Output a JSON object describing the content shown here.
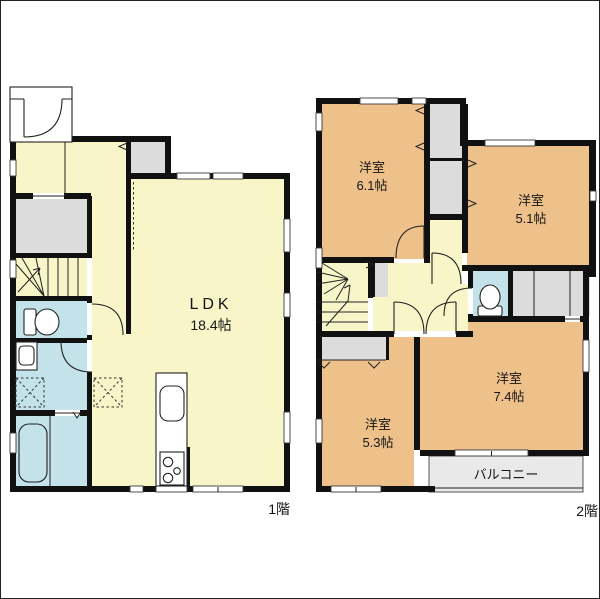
{
  "floors": [
    {
      "label": "1階",
      "rooms": [
        {
          "name": "LDK",
          "size": "18.4帖"
        }
      ]
    },
    {
      "label": "2階",
      "rooms": [
        {
          "name": "洋室",
          "size": "6.1帖"
        },
        {
          "name": "洋室",
          "size": "5.1帖"
        },
        {
          "name": "洋室",
          "size": "7.4帖"
        },
        {
          "name": "洋室",
          "size": "5.3帖"
        },
        {
          "name": "バルコニー",
          "size": ""
        }
      ]
    }
  ],
  "colors": {
    "wall": "#111111",
    "living": "#F8F5C9",
    "bedroom": "#EEC08A",
    "wet_area": "#C4E2E9",
    "closet": "#DCDCDC",
    "balcony": "#E9E9E9",
    "paper": "#FFFFFF",
    "line": "#222222"
  }
}
